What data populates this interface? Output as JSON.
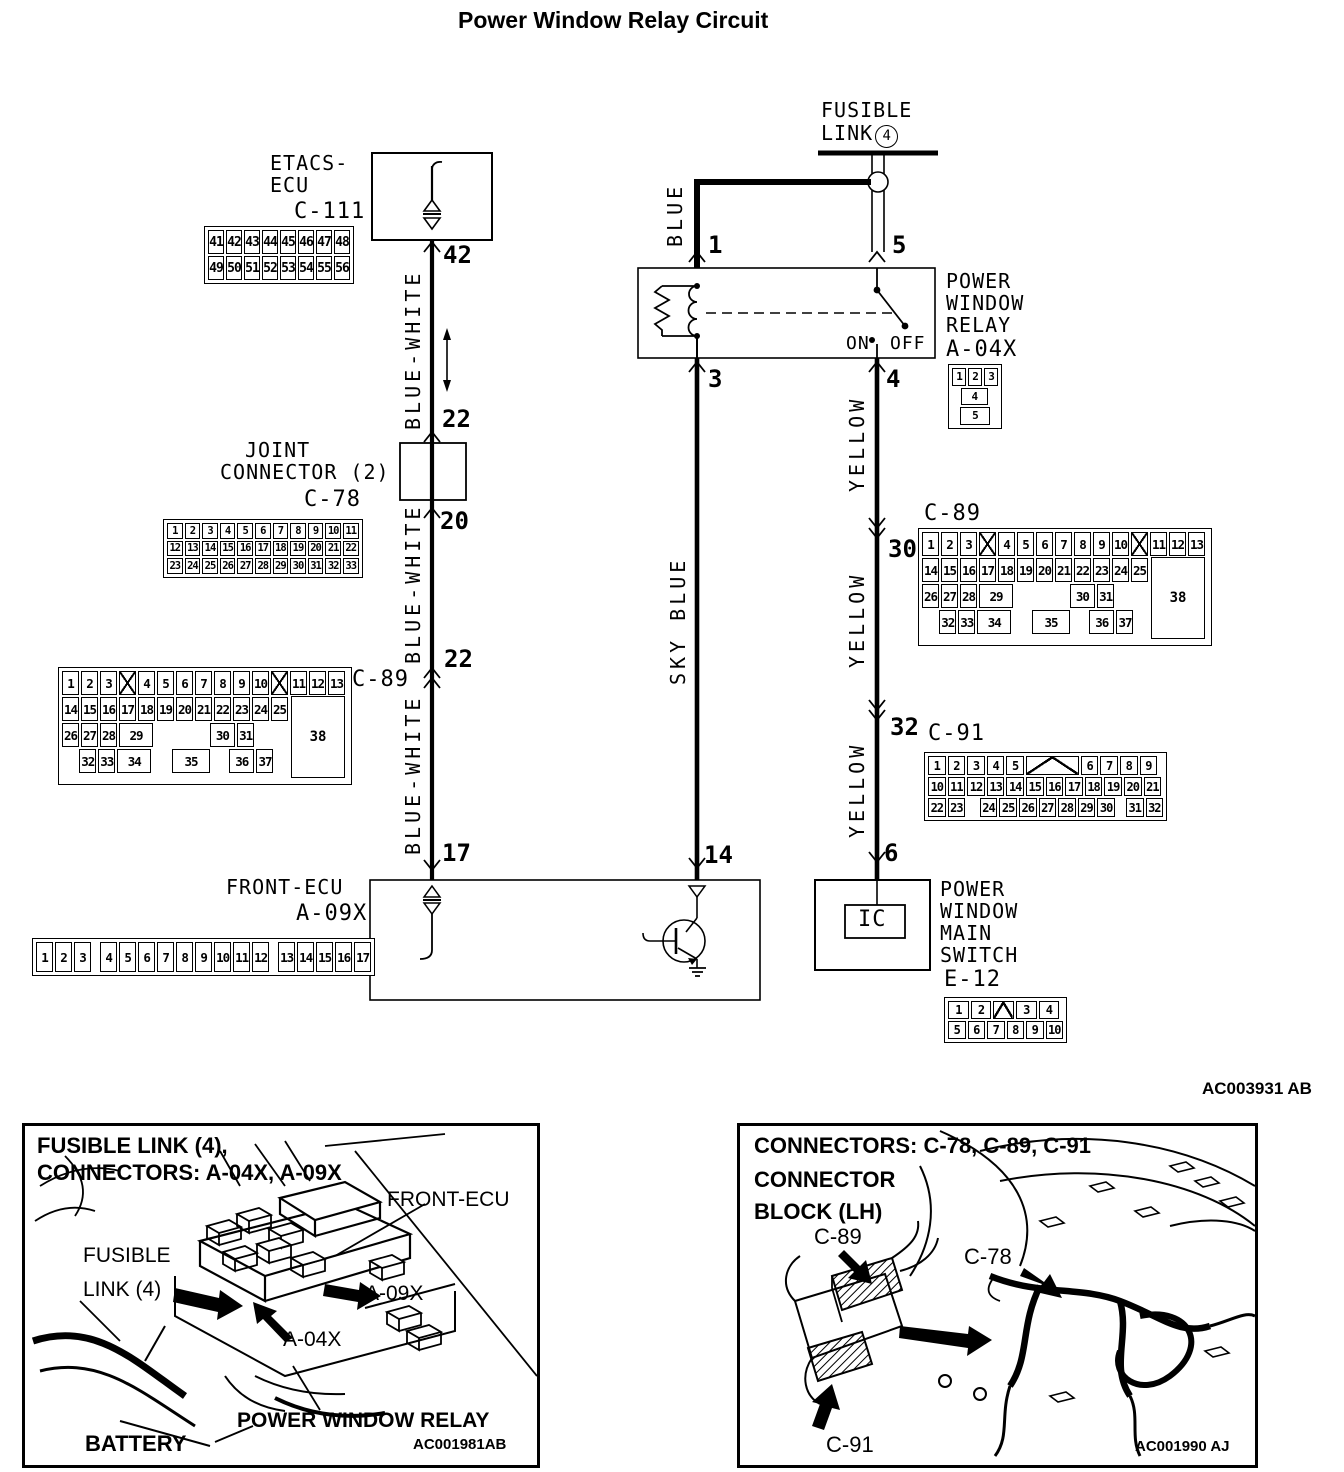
{
  "d": {
    "title": "Power Window Relay Circuit",
    "code": "AC003931 AB",
    "fusible1": "FUSIBLE",
    "fusible2": "LINK",
    "fusible_num": "4",
    "etacs1": "ETACS-",
    "etacs2": "ECU",
    "c111": "C-111",
    "joint1": "JOINT",
    "joint2": "CONNECTOR (2)",
    "c78": "C-78",
    "relay1": "POWER",
    "relay2": "WINDOW",
    "relay3": "RELAY",
    "a04x": "A-04X",
    "on": "ON",
    "off": "OFF",
    "c89l": "C-89",
    "c89r": "C-89",
    "c91": "C-91",
    "frontecu": "FRONT-ECU",
    "a09x": "A-09X",
    "msw1": "POWER",
    "msw2": "WINDOW",
    "msw3": "MAIN",
    "msw4": "SWITCH",
    "e12": "E-12",
    "ic": "IC",
    "blue": "BLUE",
    "sky": "SKY BLUE",
    "bw1": "BLUE-WHITE",
    "bw2": "BLUE-WHITE",
    "bw3": "BLUE-WHITE",
    "y1": "YELLOW",
    "y2": "YELLOW",
    "y3": "YELLOW",
    "p42": "42",
    "p22a": "22",
    "p20": "20",
    "p22b": "22",
    "p17": "17",
    "p1": "1",
    "p5": "5",
    "p3": "3",
    "p4": "4",
    "p30": "30",
    "p32": "32",
    "p14": "14",
    "p6": "6"
  },
  "connectors": {
    "c111": {
      "rows": [
        [
          "41",
          "42",
          "43",
          "44",
          "45",
          "46",
          "47",
          "48"
        ],
        [
          "49",
          "50",
          "51",
          "52",
          "53",
          "54",
          "55",
          "56"
        ]
      ]
    },
    "c78": {
      "rows": [
        [
          "1",
          "2",
          "3",
          "4",
          "5",
          "6",
          "7",
          "8",
          "9",
          "10",
          "11"
        ],
        [
          "12",
          "13",
          "14",
          "15",
          "16",
          "17",
          "18",
          "19",
          "20",
          "21",
          "22"
        ],
        [
          "23",
          "24",
          "25",
          "26",
          "27",
          "28",
          "29",
          "30",
          "31",
          "32",
          "33"
        ]
      ]
    },
    "c89": {
      "block": "38",
      "rows": [
        [
          "1",
          "2",
          "3",
          {
            "x": 1
          },
          "4",
          "5",
          "6",
          "7",
          "8",
          "9",
          "10",
          {
            "x": 1
          },
          "11",
          "12",
          "13"
        ],
        [
          "14",
          "15",
          "16",
          "17",
          "18",
          "19",
          "20",
          "21",
          "22",
          "23",
          "24",
          "25"
        ],
        [
          "26",
          "27",
          "28",
          {
            "t": "29",
            "w": 2
          },
          {
            "gap": 1,
            "w": 3.1
          },
          {
            "t": "30",
            "w": 1.5
          },
          "31"
        ],
        [
          {
            "gap": 1,
            "w": 0.9
          },
          "32",
          "33",
          {
            "t": "34",
            "w": 2
          },
          {
            "gap": 1,
            "w": 1
          },
          {
            "t": "35",
            "w": 2.2
          },
          {
            "gap": 1,
            "w": 0.9
          },
          {
            "t": "36",
            "w": 1.5
          },
          "37"
        ]
      ]
    },
    "c91": {
      "rows": [
        [
          "1",
          "2",
          "3",
          "4",
          "5",
          {
            "notch": 1,
            "w": 3
          },
          "6",
          "7",
          "8",
          "9"
        ],
        [
          "10",
          "11",
          "12",
          "13",
          "14",
          "15",
          "16",
          "17",
          "18",
          "19",
          "20",
          "21"
        ],
        [
          "22",
          "23",
          {
            "gap": 1,
            "w": 0.6
          },
          "24",
          "25",
          "26",
          "27",
          "28",
          "29",
          "30",
          {
            "gap": 1,
            "w": 0.4
          },
          "31",
          "32"
        ]
      ]
    },
    "a09x": {
      "rows": [
        [
          "1",
          "2",
          "3",
          {
            "gap": 1,
            "w": 0.3
          },
          "4",
          "5",
          "6",
          "7",
          "8",
          "9",
          "10",
          "11",
          "12",
          {
            "gap": 1,
            "w": 0.3
          },
          "13",
          "14",
          "15",
          "16",
          "17"
        ]
      ]
    },
    "a04x": {
      "rows": [
        [
          "1",
          "2",
          "3"
        ],
        [
          {
            "gap": 1,
            "w": 0.5
          },
          {
            "t": "4",
            "w": 1.9
          },
          {
            "gap": 1,
            "w": 0.6
          }
        ],
        [
          {
            "gap": 1,
            "w": 0.4
          },
          {
            "t": "5",
            "w": 2.2
          },
          {
            "gap": 1,
            "w": 0.4
          }
        ]
      ]
    },
    "e12": {
      "rows": [
        [
          {
            "t": "1",
            "w": 1.18
          },
          {
            "t": "2",
            "w": 1.18
          },
          {
            "notch": 1,
            "w": 1.18
          },
          {
            "t": "3",
            "w": 1.18
          },
          {
            "t": "4",
            "w": 1.18
          }
        ],
        [
          "5",
          "6",
          "7",
          "8",
          "9",
          "10"
        ]
      ]
    }
  },
  "panels": {
    "left": {
      "title1": "FUSIBLE LINK (4),",
      "title2": "CONNECTORS: A-04X, A-09X",
      "fus1": "FUSIBLE",
      "fus2": "LINK (4)",
      "frontecu": "FRONT-ECU",
      "a09x": "A-09X",
      "a04x": "A-04X",
      "relay": "POWER WINDOW RELAY",
      "battery": "BATTERY",
      "code": "AC001981AB"
    },
    "right": {
      "title": "CONNECTORS: C-78, C-89, C-91",
      "sub1": "CONNECTOR",
      "sub2": "BLOCK (LH)",
      "c89": "C-89",
      "c78": "C-78",
      "c91": "C-91",
      "code": "AC001990 AJ"
    }
  }
}
